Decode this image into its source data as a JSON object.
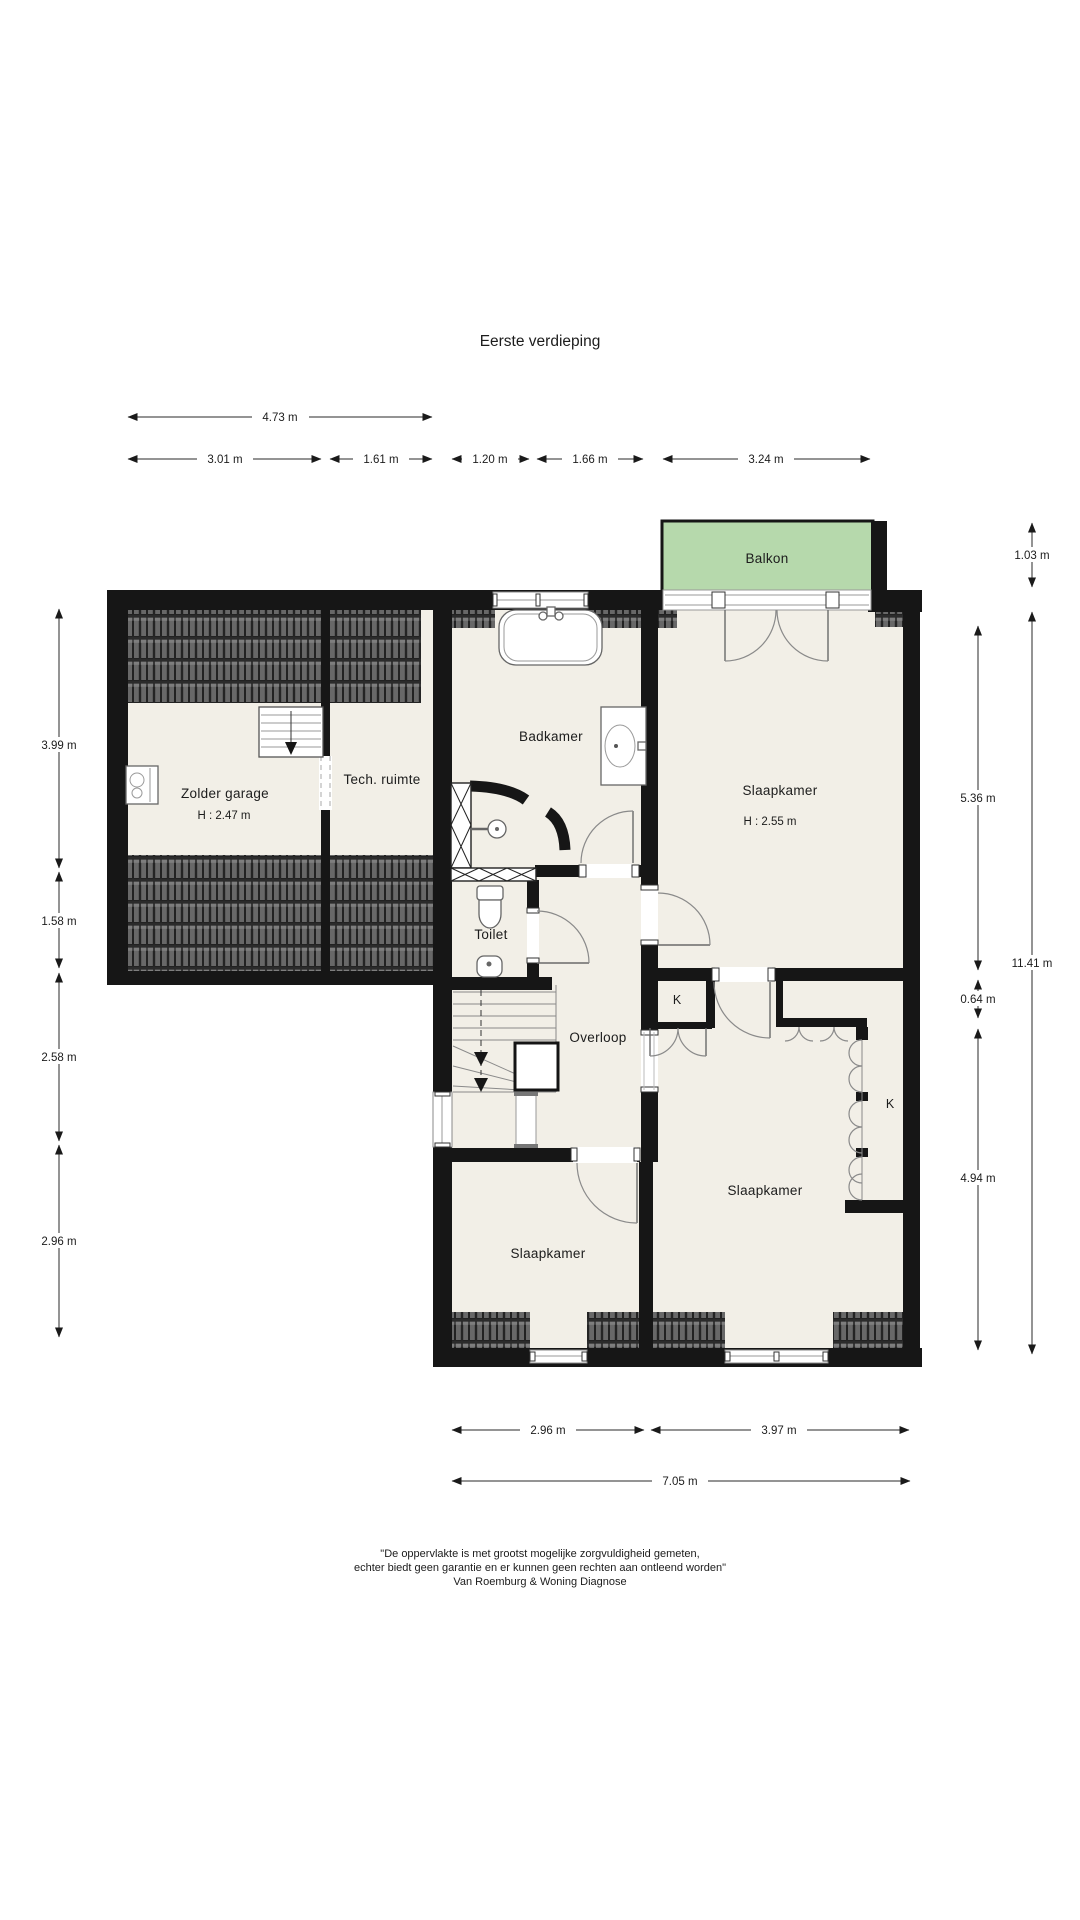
{
  "page": {
    "title": "Eerste verdieping"
  },
  "rooms": {
    "balkon": "Balkon",
    "badkamer": "Badkamer",
    "slaapkamer_ne": "Slaapkamer",
    "slaapkamer_ne_height": "H : 2.55 m",
    "zolder_garage": "Zolder garage",
    "zolder_garage_height": "H : 2.47 m",
    "tech_ruimte": "Tech. ruimte",
    "toilet": "Toilet",
    "overloop": "Overloop",
    "kast_1": "K",
    "kast_2": "K",
    "slaapkamer_sw": "Slaapkamer",
    "slaapkamer_se": "Slaapkamer"
  },
  "dimensions": {
    "top_total": "4.73 m",
    "top_segments": [
      "3.01 m",
      "1.61 m",
      "1.20 m",
      "1.66 m",
      "3.24 m"
    ],
    "left": [
      "3.99 m",
      "1.58 m",
      "2.58 m",
      "2.96 m"
    ],
    "right_inner": [
      "5.36 m",
      "0.64 m",
      "4.94 m"
    ],
    "right_outer": [
      "1.03 m",
      "11.41 m"
    ],
    "bottom_segments": [
      "2.96 m",
      "3.97 m"
    ],
    "bottom_total": "7.05 m"
  },
  "footer": {
    "line1": "\"De oppervlakte is met grootst mogelijke zorgvuldigheid gemeten,",
    "line2": "echter biedt geen garantie en er kunnen geen rechten aan ontleend worden\"",
    "line3": "Van Roemburg & Woning Diagnose"
  },
  "colors": {
    "wall": "#161616",
    "floor": "#f2efe7",
    "balkon_fill": "#b6d9ac",
    "roof_tile": "#666666"
  }
}
